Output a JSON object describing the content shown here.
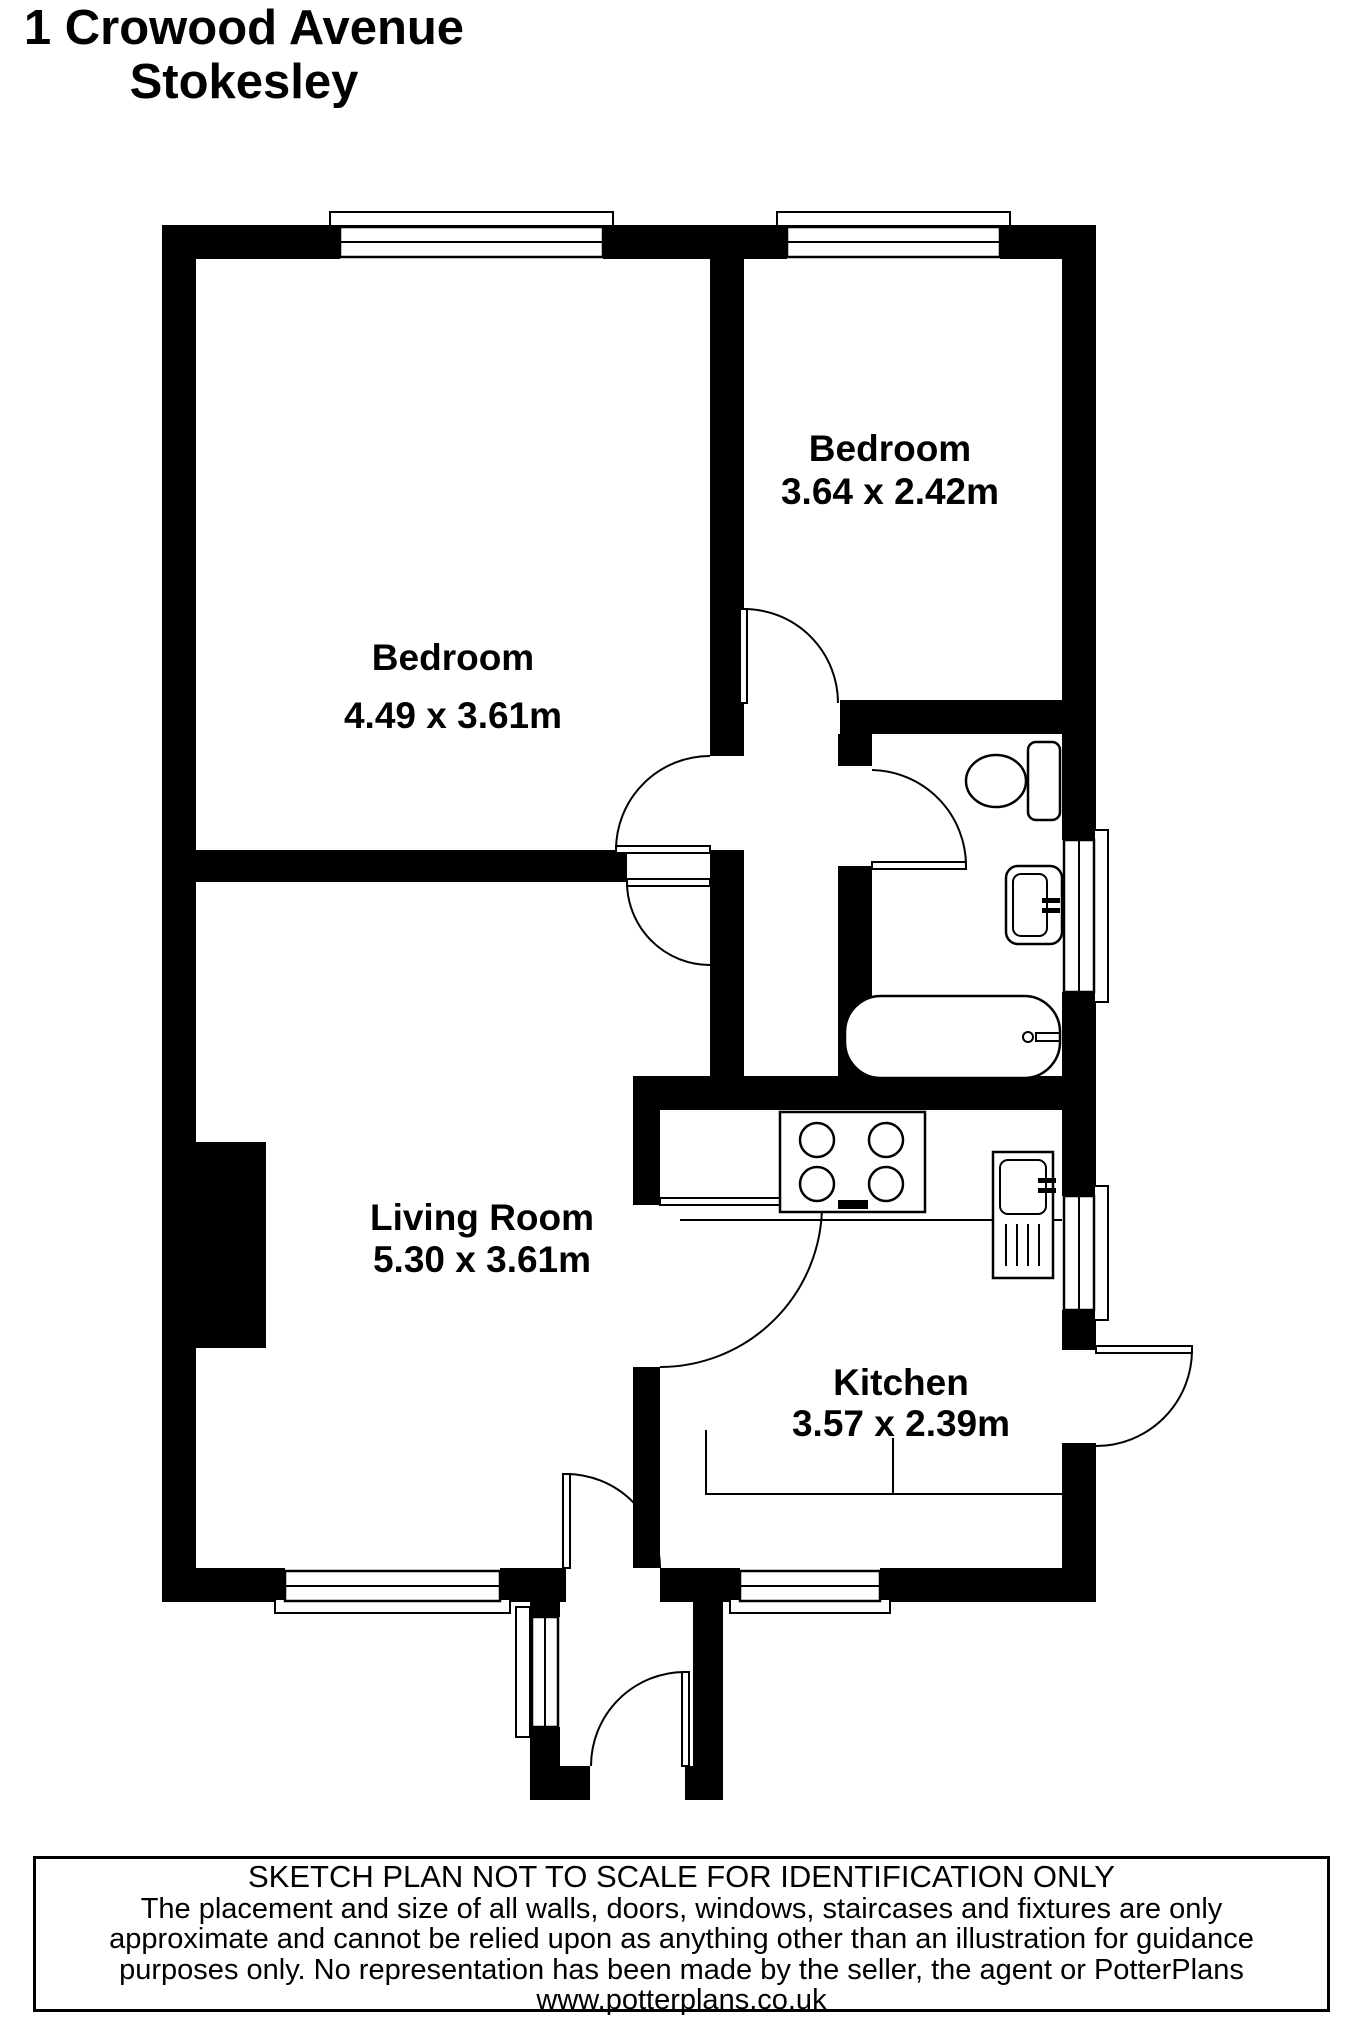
{
  "title": {
    "line1": "1 Crowood Avenue",
    "line2": "Stokesley"
  },
  "rooms": [
    {
      "name": "Bedroom",
      "dimensions": "4.49 x 3.61m"
    },
    {
      "name": "Bedroom",
      "dimensions": "3.64 x 2.42m"
    },
    {
      "name": "Living Room",
      "dimensions": "5.30 x 3.61m"
    },
    {
      "name": "Kitchen",
      "dimensions": "3.57 x 2.39m"
    }
  ],
  "fixtures": {
    "bathroom": [
      "toilet",
      "wash-basin",
      "bath"
    ],
    "kitchen": [
      "hob",
      "sink-drainer",
      "counter"
    ]
  },
  "footer": {
    "line1": "SKETCH PLAN NOT TO SCALE FOR IDENTIFICATION ONLY",
    "line2": "The placement and size of all walls, doors, windows, staircases and fixtures are only",
    "line3": "approximate and cannot be relied upon as anything other than an illustration for guidance",
    "line4": "purposes only. No representation has been made by the seller, the agent or PotterPlans",
    "line5": "www.potterplans.co.uk"
  },
  "colors": {
    "walls": "#000000",
    "background": "#ffffff",
    "text": "#000000"
  }
}
